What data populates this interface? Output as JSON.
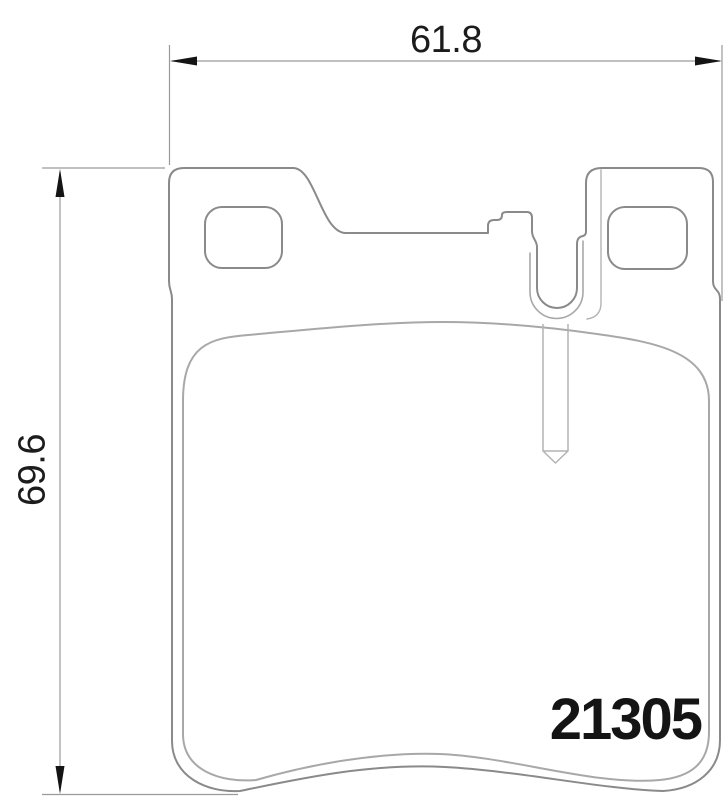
{
  "drawing": {
    "type": "brake-pad-technical-drawing",
    "view": "backplate-front-view",
    "part_number": "21305",
    "dimensions": {
      "width": {
        "value": "61.8",
        "orientation": "horizontal",
        "position": "top"
      },
      "height": {
        "value": "69.6",
        "orientation": "vertical",
        "position": "left"
      }
    },
    "features": {
      "mounting_holes": 2,
      "center_slot": "u-shaped sensor slot",
      "wear_sensor_pin": "vertical pin with pointed tip below slot"
    },
    "colors": {
      "background": "#ffffff",
      "plate_outline": "#8a8a8a",
      "friction_outline": "#a8a8a8",
      "pin_outline": "#b3b3b3",
      "dimension_line": "#9a9a9a",
      "arrow_and_text": "#141414"
    }
  }
}
